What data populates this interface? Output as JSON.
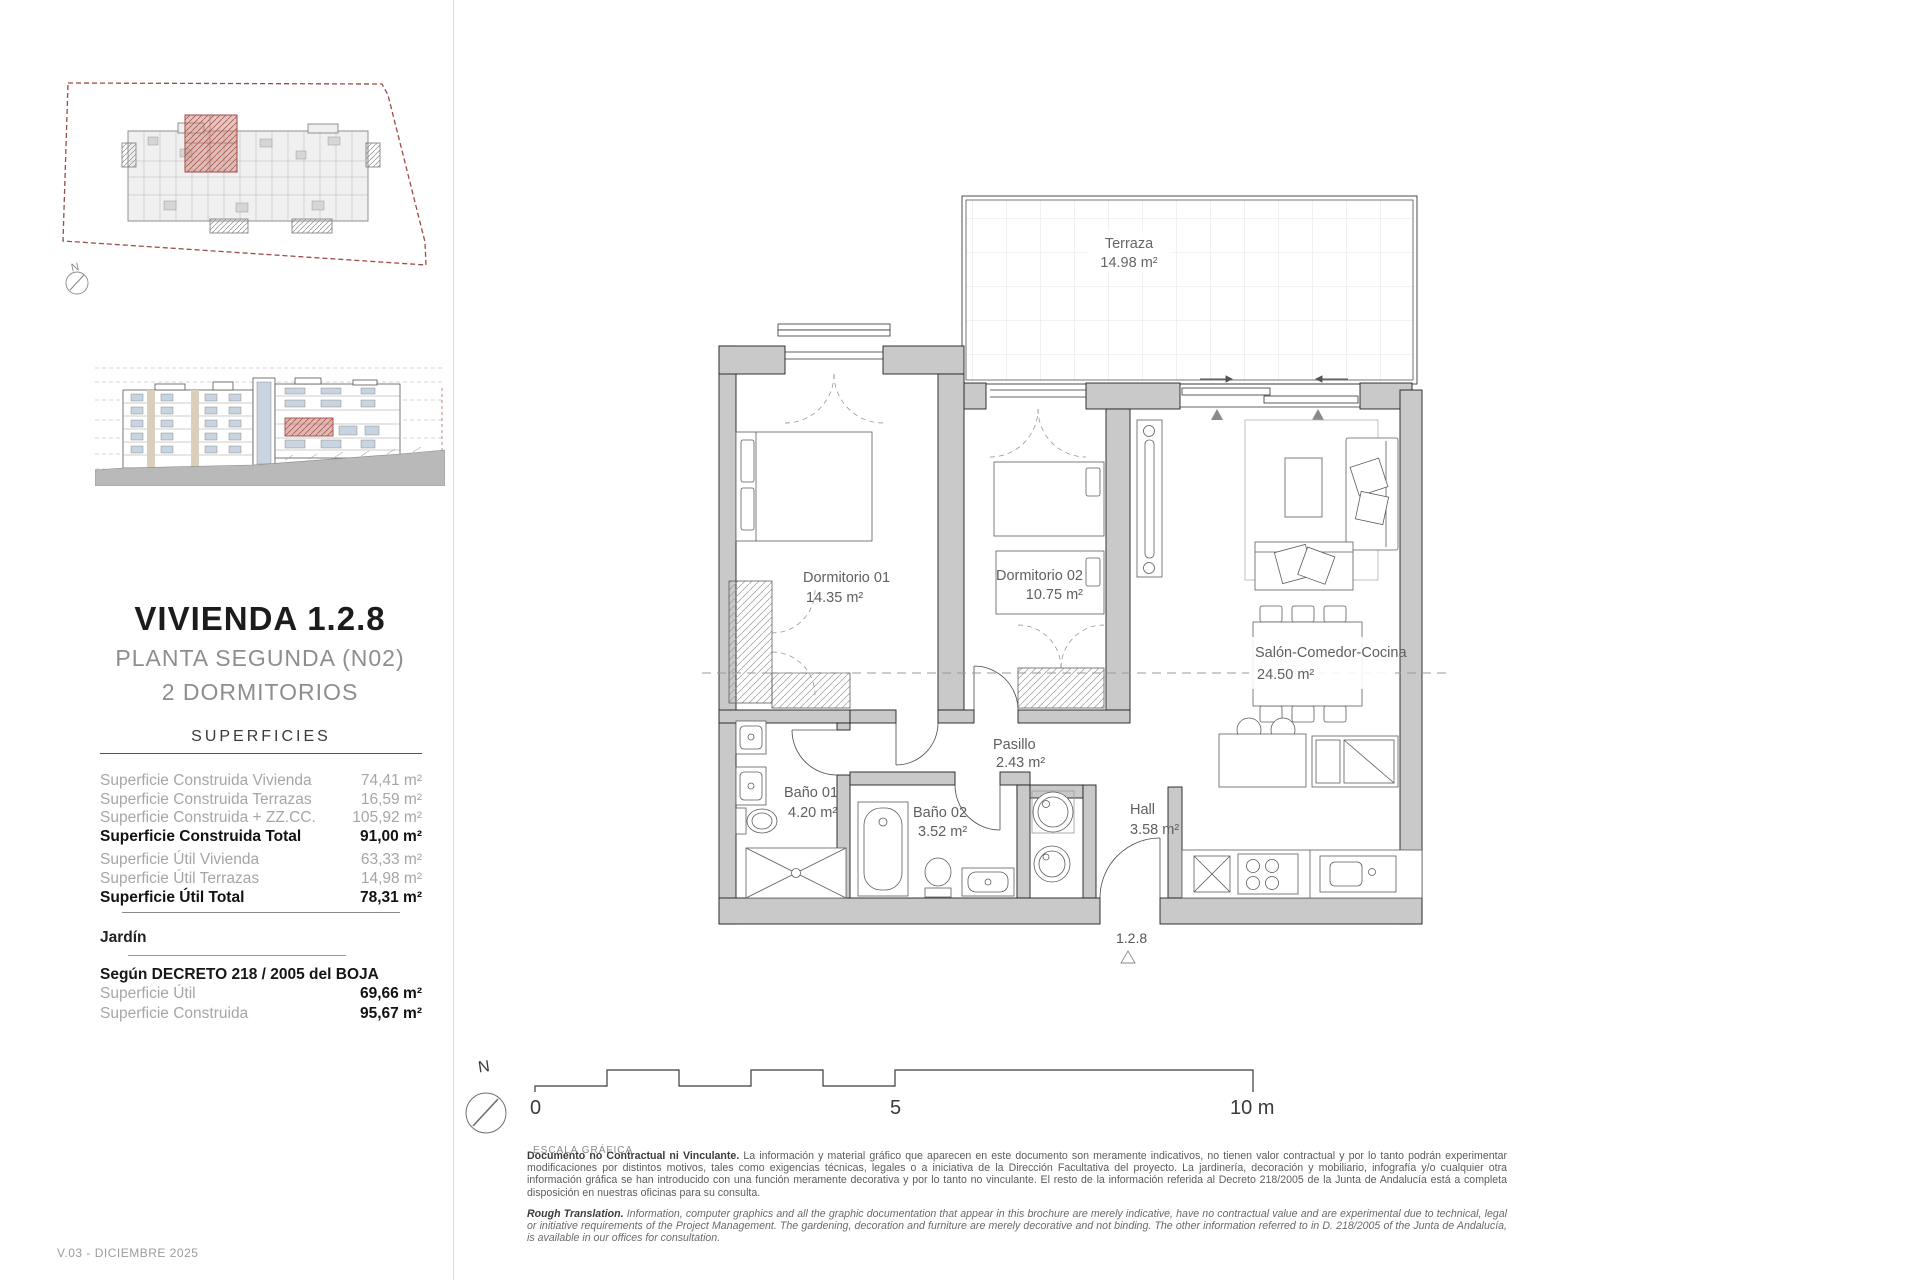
{
  "sidebar": {
    "north_label": "N",
    "title": "VIVIENDA 1.2.8",
    "subtitle_line1": "PLANTA SEGUNDA (N02)",
    "subtitle_line2": "2 DORMITORIOS",
    "superficies": {
      "heading": "SUPERFICIES",
      "rows": [
        {
          "label": "Superficie Construida Vivienda",
          "value": "74,41 m²"
        },
        {
          "label": "Superficie Construida Terrazas",
          "value": "16,59 m²"
        },
        {
          "label": "Superficie Construida + ZZ.CC.",
          "value": "105,92 m²"
        },
        {
          "label": "Superficie Construida Total",
          "value": "91,00 m²"
        },
        {
          "label": "Superficie Útil Vivienda",
          "value": "63,33 m²"
        },
        {
          "label": "Superficie Útil Terrazas",
          "value": "14,98 m²"
        },
        {
          "label": "Superficie Útil Total",
          "value": "78,31 m²"
        }
      ],
      "jardin": "Jardín",
      "decreto_heading": "Según DECRETO 218 / 2005 del BOJA",
      "decreto_rows": [
        {
          "label": "Superficie Útil",
          "value": "69,66 m²"
        },
        {
          "label": "Superficie Construida",
          "value": "95,67 m²"
        }
      ]
    }
  },
  "plan": {
    "rooms": {
      "terraza": {
        "name": "Terraza",
        "area": "14.98 m²"
      },
      "dorm1": {
        "name": "Dormitorio 01",
        "area": "14.35 m²"
      },
      "dorm2": {
        "name": "Dormitorio 02",
        "area": "10.75 m²"
      },
      "salon": {
        "name": "Salón-Comedor-Cocina",
        "area": "24.50 m²"
      },
      "pasillo": {
        "name": "Pasillo",
        "area": "2.43 m²"
      },
      "bano1": {
        "name": "Baño 01",
        "area": "4.20 m²"
      },
      "bano2": {
        "name": "Baño 02",
        "area": "3.52 m²"
      },
      "hall": {
        "name": "Hall",
        "area": "3.58 m²"
      }
    },
    "unit_label": "1.2.8"
  },
  "scalebar": {
    "north_label": "N",
    "tick_0": "0",
    "tick_5": "5",
    "tick_10": "10 m",
    "caption": "ESCALA GRÁFICA"
  },
  "footer": {
    "es_lead": "Documento no Contractual ni Vinculante.",
    "es_body": " La información y material gráfico que aparecen en este documento son meramente indicativos, no tienen valor contractual y por lo tanto podrán experimentar modificaciones por distintos motivos, tales como exigencias técnicas, legales o a iniciativa de la Dirección Facultativa del proyecto. La jardinería, decoración y mobiliario, infografía y/o cualquier otra información gráfica se han introducido con una función meramente decorativa y por lo tanto no vinculante. El resto de la información referida al Decreto 218/2005 de la Junta de Andalucía está a completa disposición en nuestras oficinas para su consulta.",
    "en_lead": "Rough Translation.",
    "en_body": " Information, computer graphics and all the graphic documentation that appear in this brochure are merely indicative, have no contractual value and are experimental due to technical, legal or initiative requirements of the Project Management. The gardening, decoration and furniture are merely decorative and not binding. The other information referred to in D. 218/2005 of the Junta de Andalucía, is available in our offices for consultation.",
    "version": "V.03 - DICIEMBRE 2025"
  },
  "colors": {
    "highlight_red": "#a14c44",
    "wall_gray": "#c9c9c9"
  }
}
